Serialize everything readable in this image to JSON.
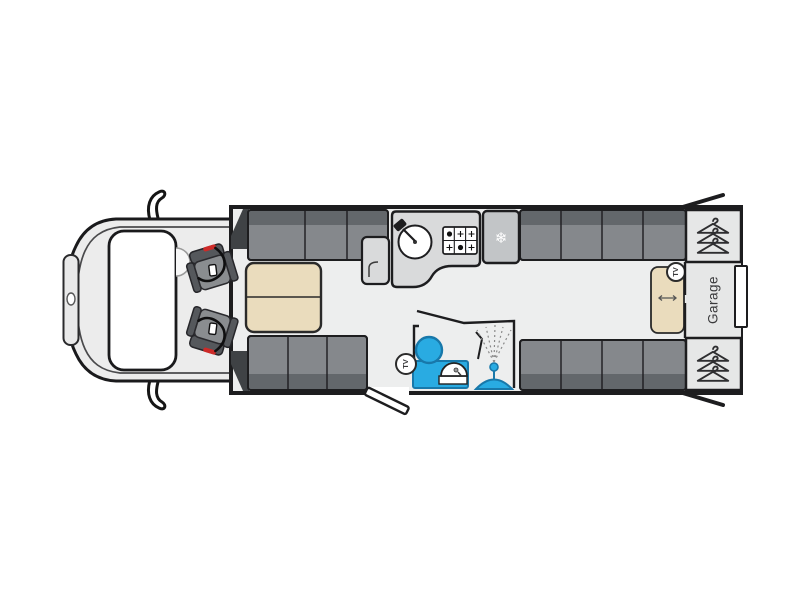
{
  "floorplan": {
    "labels": {
      "garage": "Garage",
      "tv_bathroom": "TV",
      "tv_bedroom": "TV"
    },
    "icons": {
      "snowflake": "❄",
      "hanger_count_per_wardrobe": 3
    },
    "colors": {
      "background": "#ffffff",
      "floor": "#edeeee",
      "wall": "#1d1d1f",
      "body_shell": "#ececec",
      "upholstery": "#85888c",
      "upholstery_dark": "#63676b",
      "seat_gray": "#8a8d90",
      "seat_dark": "#55585c",
      "seat_red": "#cd2a28",
      "cabinet_gray": "#d9dadb",
      "fridge_gray": "#c2c5c7",
      "wardrobe_gray": "#e6e7e7",
      "table_beige": "#eadcbd",
      "fixture_blue": "#29abe2",
      "fixture_blue_dark": "#1878aa",
      "window_white": "#ffffff"
    }
  }
}
